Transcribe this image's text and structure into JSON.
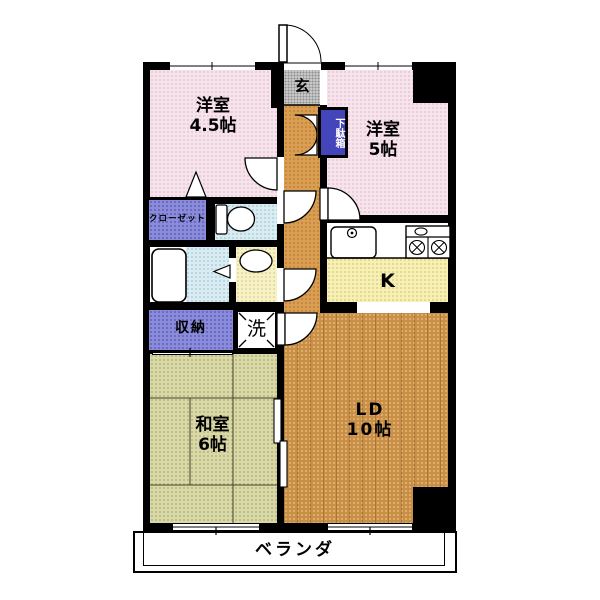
{
  "plan": {
    "western_room_45": {
      "name": "洋室",
      "size": "4.5帖"
    },
    "western_room_5": {
      "name": "洋室",
      "size": "5帖"
    },
    "entrance": {
      "label": "玄"
    },
    "shoe_cabinet": {
      "label": "下駄箱"
    },
    "closet": {
      "label": "クローゼット"
    },
    "kitchen": {
      "label": "K"
    },
    "storage": {
      "label": "収納"
    },
    "laundry": {
      "label": "洗"
    },
    "japanese_room": {
      "name": "和室",
      "size": "6帖"
    },
    "living_dining": {
      "name": "LD",
      "size": "10帖"
    },
    "veranda": {
      "label": "ベランダ"
    }
  },
  "palette": {
    "wall": "#000000",
    "western_room_floor": "#f7e3ec",
    "entrance_floor": "#c7c7c7",
    "hallway_floor": "#d99e52",
    "kitchen_floor": "#f7f0b5",
    "wet_area_floor": "#d9ecf2",
    "washroom_floor": "#f7f2c5",
    "closet_fill": "#8b8bdc",
    "shoe_cabinet_fill": "#4444bb",
    "tatami_floor": "#d9d9a8",
    "wood_floor": "#c98f46",
    "veranda_floor": "#ffffff"
  }
}
